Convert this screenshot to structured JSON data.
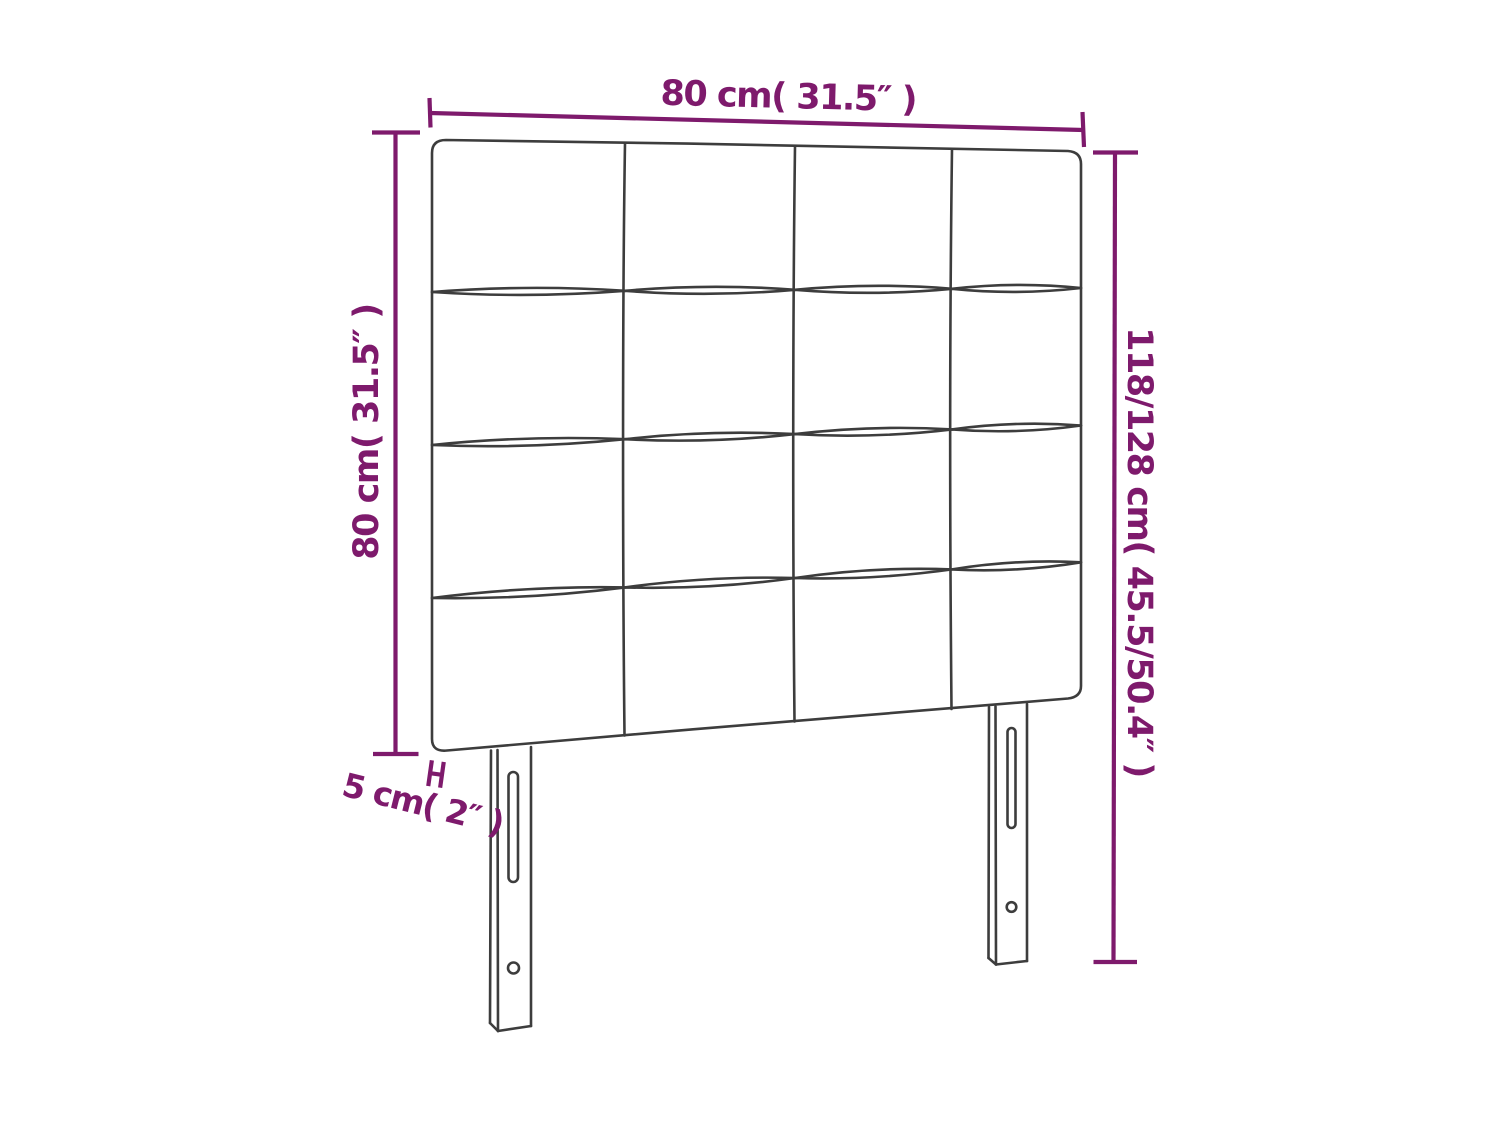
{
  "diagram": {
    "kind": "product-dimension-diagram",
    "labels": {
      "width": "80 cm( 31.5″ )",
      "height": "80 cm( 31.5″ )",
      "total_height": "118/128 cm( 45.5/50.4″ )",
      "thickness": "5 cm( 2″ )"
    },
    "grid": {
      "rows": 4,
      "columns": 4
    },
    "colors": {
      "dimension": "#7E1A6C",
      "outline": "#3D3D3D",
      "background": "#FFFFFF"
    }
  }
}
